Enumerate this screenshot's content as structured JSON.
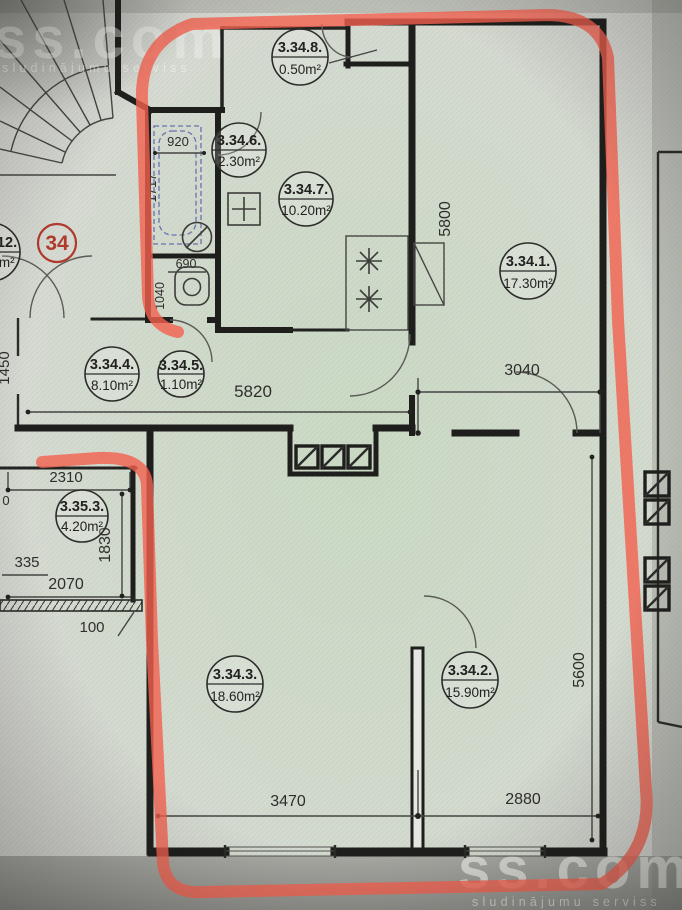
{
  "photo": {
    "description": "apartment floor plan photo with red marker outline",
    "brand": "ss.com",
    "tagline": "sludinājumu serviss"
  },
  "apartment_badge": "34",
  "rooms": [
    {
      "label": "3.34.1.",
      "area": "17.30m²"
    },
    {
      "label": "3.34.2.",
      "area": "15.90m²"
    },
    {
      "label": "3.34.3.",
      "area": "18.60m²"
    },
    {
      "label": "3.34.4.",
      "area": "8.10m²"
    },
    {
      "label": "3.34.5.",
      "area": "1.10m²"
    },
    {
      "label": "3.34.6.",
      "area": "2.30m²"
    },
    {
      "label": "3.34.7.",
      "area": "10.20m²"
    },
    {
      "label": "3.34.8.",
      "area": "0.50m²"
    },
    {
      "label": "3.35.3.",
      "area": "4.20m²"
    },
    {
      "label": ".12.",
      "area": "0m²"
    }
  ],
  "dims": {
    "bath_w": "920",
    "bath_l": "1717",
    "wc_w": "690",
    "wc_l": "1040",
    "living_h": "5800",
    "hall_w": "5820",
    "living_w": "3040",
    "entry_h": "1450",
    "nb_w": "2310",
    "nb_h": "1830",
    "nb_335": "335",
    "nb_2070": "2070",
    "nb_100": "100",
    "r3_w": "3470",
    "r2_w": "2880",
    "right_h": "5600",
    "partial": "0"
  },
  "colors": {
    "marker_red": "#f2604f",
    "wall_black": "#1e1e1c",
    "badge_red": "#b03a2e",
    "paper": "#d9dad5",
    "green_tint": "#cfe0c9",
    "photo_gray": "#9c9d97"
  }
}
